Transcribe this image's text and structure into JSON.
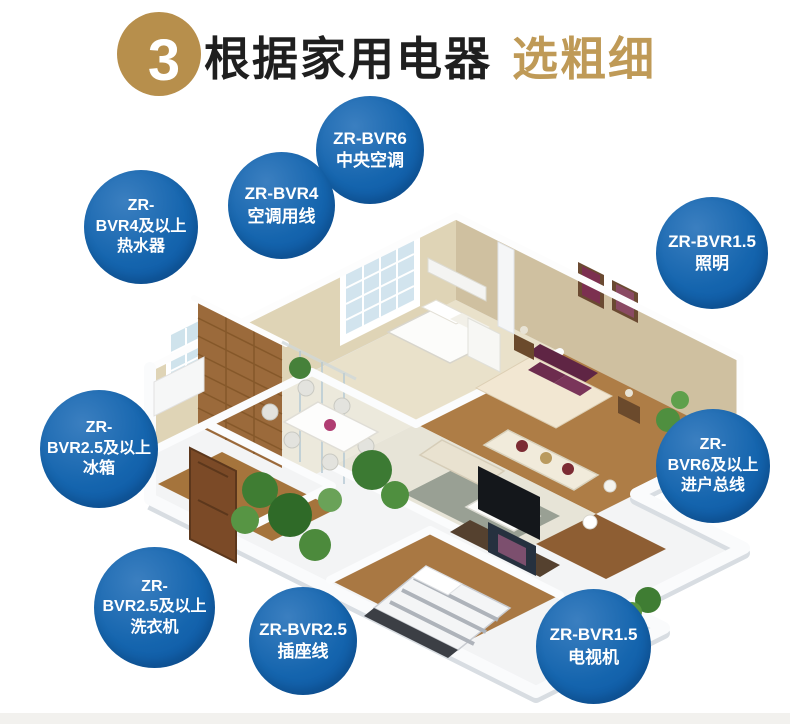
{
  "header": {
    "step_number": "3",
    "title_black": "根据家用电器",
    "title_gold": "选粗细"
  },
  "badges": [
    {
      "id": "central-ac",
      "appliance": "中央空调",
      "lines": [
        "ZR-BVR6",
        "中央空调"
      ]
    },
    {
      "id": "ac-wire",
      "appliance": "空调用线",
      "lines": [
        "ZR-BVR4",
        "空调用线"
      ]
    },
    {
      "id": "water-heater",
      "appliance": "热水器",
      "lines": [
        "ZR-",
        "BVR4及以上",
        "热水器"
      ]
    },
    {
      "id": "lighting",
      "appliance": "照明",
      "lines": [
        "ZR-BVR1.5",
        "照明"
      ]
    },
    {
      "id": "fridge",
      "appliance": "冰箱",
      "lines": [
        "ZR-",
        "BVR2.5及以上",
        "冰箱"
      ]
    },
    {
      "id": "main-line",
      "appliance": "进户总线",
      "lines": [
        "ZR-",
        "BVR6及以上",
        "进户总线"
      ]
    },
    {
      "id": "washer",
      "appliance": "洗衣机",
      "lines": [
        "ZR-",
        "BVR2.5及以上",
        "洗衣机"
      ]
    },
    {
      "id": "socket",
      "appliance": "插座线",
      "lines": [
        "ZR-BVR2.5",
        "插座线"
      ]
    },
    {
      "id": "tv",
      "appliance": "电视机",
      "lines": [
        "ZR-BVR1.5",
        "电视机"
      ]
    }
  ],
  "colors": {
    "badge_blue": "#1565ae",
    "step_circle_gold": "#b78f4c",
    "title_gold": "#bf9a57",
    "title_black": "#1f1f1f",
    "bottom_strip": "#f2f1ee"
  }
}
